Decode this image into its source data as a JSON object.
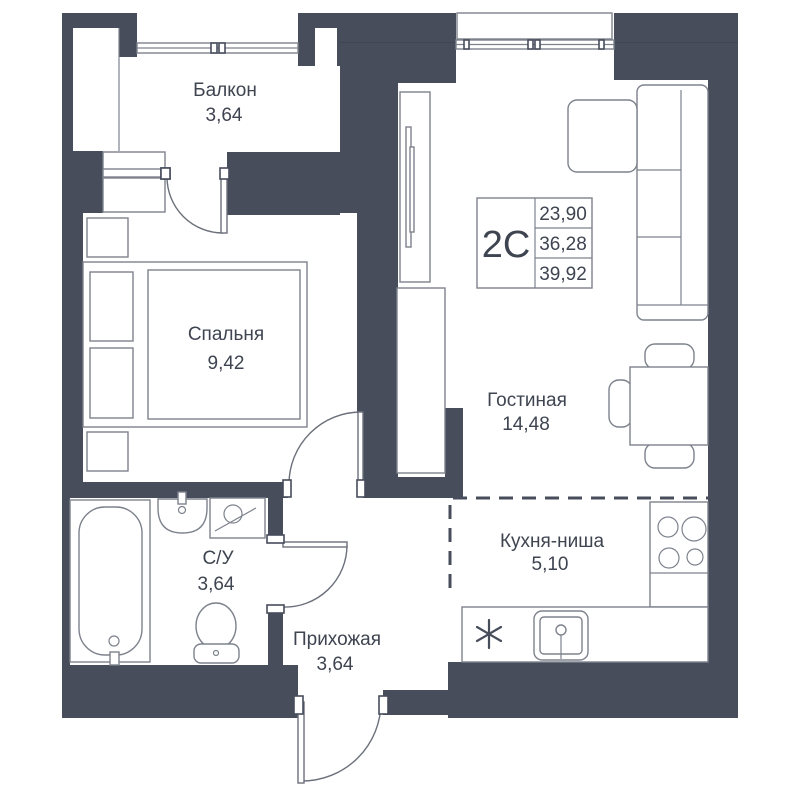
{
  "plan": {
    "info_box": {
      "unit_label": "2С",
      "values": [
        "23,90",
        "36,28",
        "39,92"
      ]
    },
    "rooms": [
      {
        "name": "Балкон",
        "area": "3,64"
      },
      {
        "name": "Спальня",
        "area": "9,42"
      },
      {
        "name": "Гостиная",
        "area": "14,48"
      },
      {
        "name": "Кухня-ниша",
        "area": "5,10"
      },
      {
        "name": "С/У",
        "area": "3,64"
      },
      {
        "name": "Прихожая",
        "area": "3,64"
      }
    ],
    "colors": {
      "wall": "#474D5B",
      "furniture_stroke": "#7d828c",
      "text": "#3e4450",
      "background": "#ffffff"
    }
  }
}
